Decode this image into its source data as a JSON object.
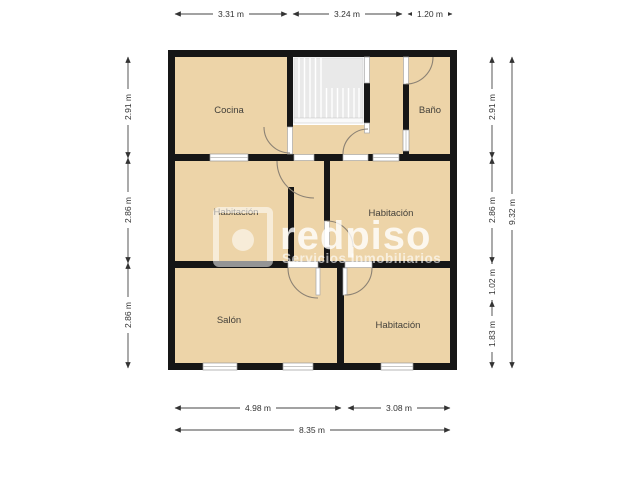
{
  "floor_plan": {
    "rooms": {
      "cocina": "Cocina",
      "bano": "Baño",
      "hab_mid_left": "Habitación",
      "hab_mid_right": "Habitación",
      "salon": "Salón",
      "hab_bottom": "Habitación"
    },
    "dimensions": {
      "top": [
        "3.31 m",
        "3.24 m",
        "1.20 m"
      ],
      "left": [
        "2.91 m",
        "2.86 m",
        "2.86 m"
      ],
      "right_inner": [
        "2.91 m",
        "2.86 m",
        "1.02 m",
        "1.83 m"
      ],
      "right_total": "9.32 m",
      "bottom": [
        "4.98 m",
        "3.08 m"
      ],
      "bottom_total": "8.35 m"
    },
    "watermark": {
      "brand": "redpiso",
      "tagline": "Servicios Inmobiliarios"
    },
    "colors": {
      "room_fill": "#edd4a8",
      "wall": "#161616",
      "stairs_fill": "#e9e9e9",
      "dimension_line": "#444444",
      "watermark": "#ffffff"
    }
  }
}
